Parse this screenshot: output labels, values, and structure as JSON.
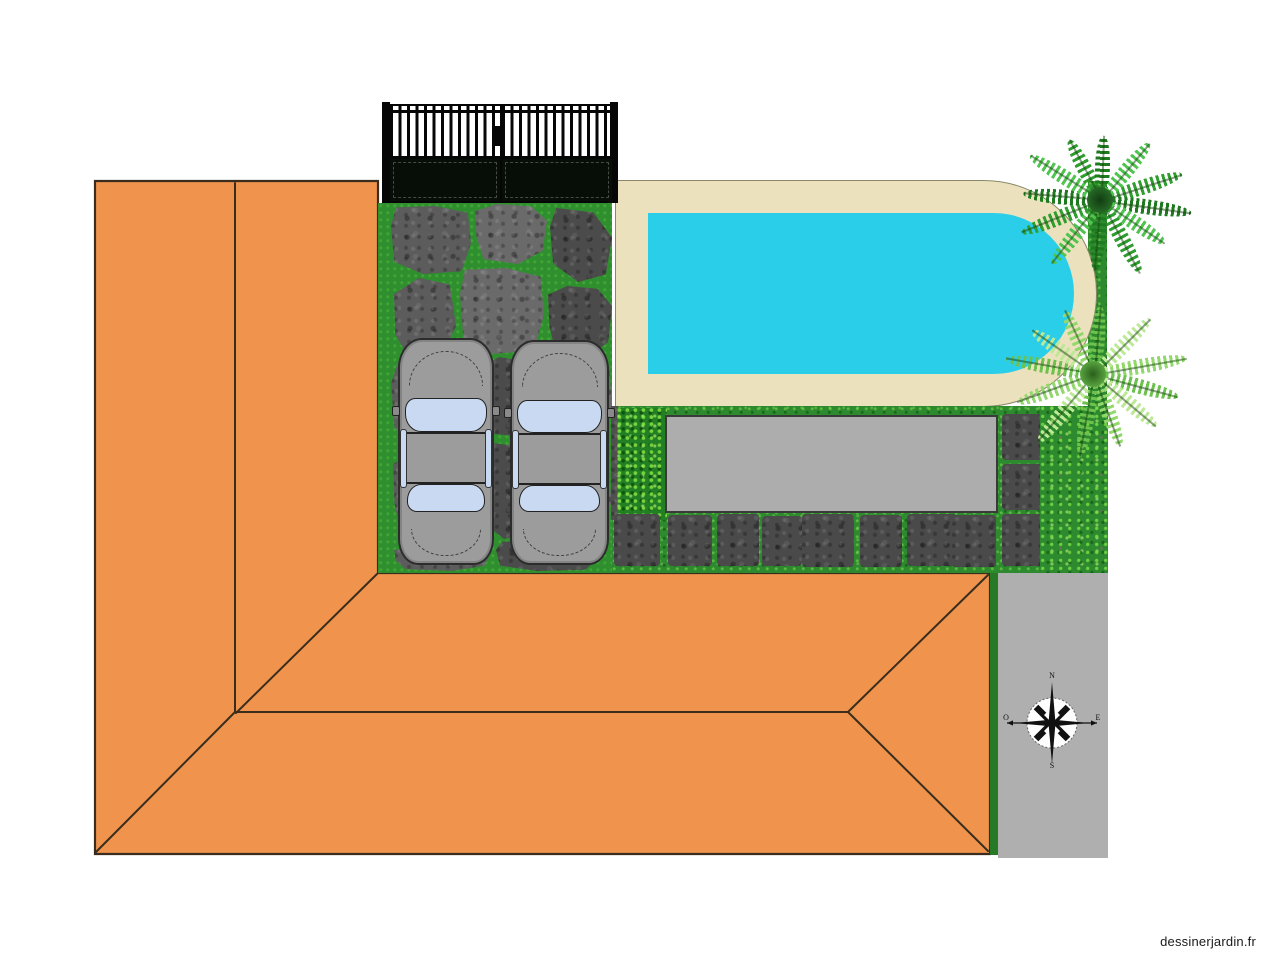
{
  "watermark": {
    "label": "dessinerjardin.fr"
  },
  "compass": {
    "north": "N",
    "south": "S",
    "east": "E",
    "west": "O"
  },
  "colors": {
    "roof": "#F0944D",
    "roof-outline": "#3A2D1E",
    "pool-water": "#2BCEE8",
    "pool-deck": "#EBE1BD",
    "deck-edge": "#8A8868",
    "grass": "#2E8A2E",
    "driveway-grass": "#2F8F2F",
    "hedge": "#237F23",
    "stone": "#5C5C5C",
    "terrace": "#ADADAD",
    "road": "#AFAFAF",
    "gate": "#060606",
    "car-body": "#9C9C9C",
    "car-window": "#C9D9F1",
    "compass-ink": "#111111",
    "watermark-ink": "#1A1A1A"
  }
}
